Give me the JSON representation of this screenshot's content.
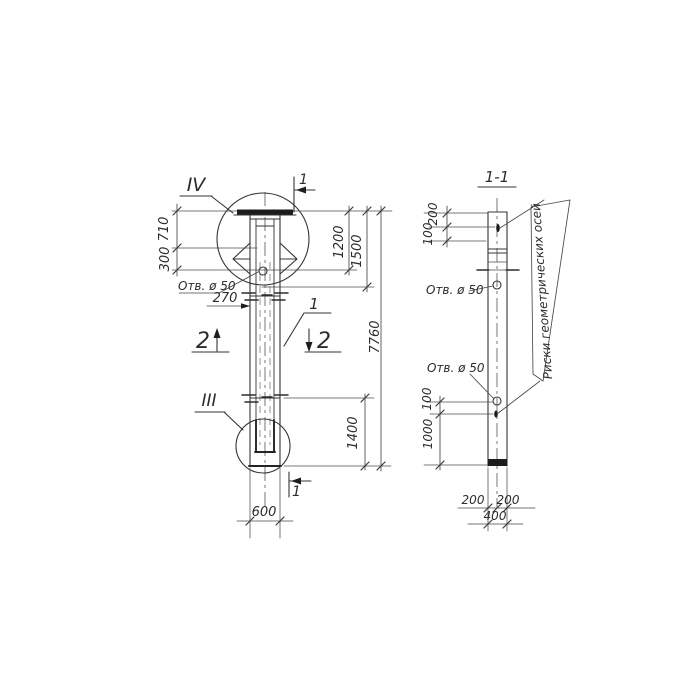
{
  "palette": {
    "ink": "#343434",
    "paper": "#ffffff"
  },
  "left_view": {
    "detail_marker_top": "IV",
    "detail_marker_bottom": "III",
    "section_cut_top": "1",
    "section_cut_bottom": "1",
    "section_cut_2_left": "2",
    "section_cut_2_right": "2",
    "part_number": "1",
    "hole_label": "Отв. ø 50",
    "dim_710": "710",
    "dim_300": "300",
    "dim_270": "270",
    "dim_1200": "1200",
    "dim_1500": "1500",
    "dim_7760": "7760",
    "dim_1400": "1400",
    "dim_600": "600"
  },
  "section_view": {
    "title": "1-1",
    "hole_label_upper": "Отв. ø 50",
    "hole_label_lower": "Отв. ø 50",
    "axes_note": "Риски геометрических осей",
    "dim_200_top": "200",
    "dim_100_top": "100",
    "dim_100_bottom": "100",
    "dim_1000": "1000",
    "dim_200_bottom_left": "200",
    "dim_200_bottom_right": "200",
    "dim_400": "400"
  }
}
